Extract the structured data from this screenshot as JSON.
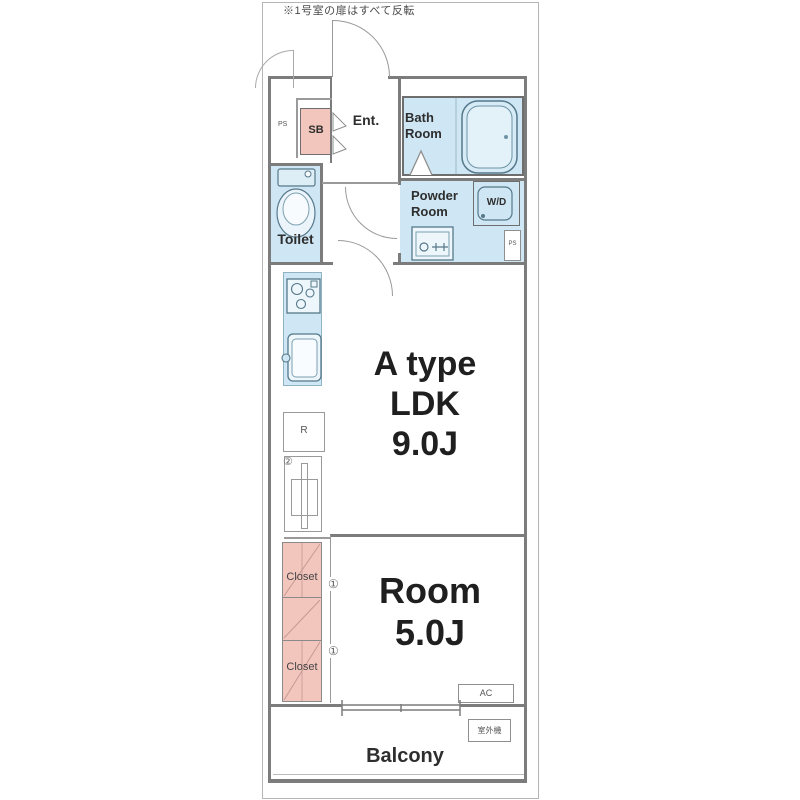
{
  "note": "※1号室の扉はすべて反転",
  "colors": {
    "water_fill": "#cfe7f4",
    "fixture_fill": "#edf6fb",
    "closet_fill": "#f2c5bd",
    "wall": "#7c7c7c",
    "fixture_stroke": "#55788a"
  },
  "rooms": {
    "entrance": {
      "label": "Ent."
    },
    "shoe_box": {
      "label": "SB"
    },
    "pipe_space_left": {
      "label": "PS"
    },
    "bath": {
      "label": "Bath\nRoom"
    },
    "powder": {
      "label": "Powder\nRoom"
    },
    "washer_dryer": {
      "label": "W/D"
    },
    "pipe_space_right": {
      "label": "PS"
    },
    "toilet": {
      "label": "Toilet"
    },
    "refrigerator": {
      "label": "R"
    },
    "ldk": {
      "label": "A type\nLDK\n9.0J"
    },
    "closet_upper": {
      "label": "Closet"
    },
    "closet_lower": {
      "label": "Closet"
    },
    "bedroom": {
      "label": "Room\n5.0J"
    },
    "ac": {
      "label": "AC"
    },
    "outdoor_unit": {
      "label": "室外機"
    },
    "balcony": {
      "label": "Balcony"
    }
  },
  "door_marks": {
    "mark1_upper": "①",
    "mark1_lower": "①",
    "mark2": "②"
  }
}
